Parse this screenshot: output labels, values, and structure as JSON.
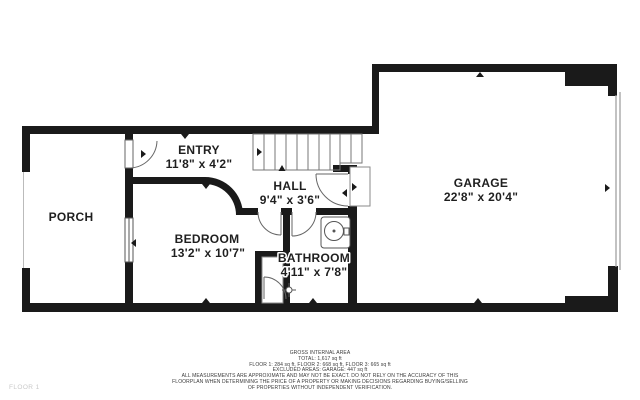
{
  "plan": {
    "floor_label": "FLOOR 1",
    "rooms": {
      "porch": {
        "label": "PORCH"
      },
      "entry": {
        "label": "ENTRY",
        "dims": "11'8\" x 4'2\""
      },
      "hall": {
        "label": "HALL",
        "dims": "9'4\" x 3'6\""
      },
      "bedroom": {
        "label": "BEDROOM",
        "dims": "13'2\" x 10'7\""
      },
      "bathroom": {
        "label": "BATHROOM",
        "dims": "4'11\" x 7'8\""
      },
      "garage": {
        "label": "GARAGE",
        "dims": "22'8\" x 20'4\""
      }
    },
    "colors": {
      "walls": "#1a1a1a",
      "thin_lines": "#777777",
      "floor_label": "#c9c9c9"
    }
  },
  "footer": {
    "lines": [
      "GROSS INTERNAL AREA",
      "TOTAL: 1,617 sq ft",
      "FLOOR 1: 284 sq ft, FLOOR 2: 668 sq ft, FLOOR 3: 665 sq ft",
      "EXCLUDED AREAS: GARAGE: 447 sq ft",
      "ALL MEASUREMENTS ARE APPROXIMATE AND MAY NOT BE EXACT. DO NOT RELY ON THE ACCURACY OF THIS",
      "FLOORPLAN WHEN DETERMINING THE PRICE OF A PROPERTY OR MAKING DECISIONS REGARDING BUYING/SELLING",
      "OF PROPERTIES WITHOUT INDEPENDENT VERIFICATION."
    ]
  }
}
